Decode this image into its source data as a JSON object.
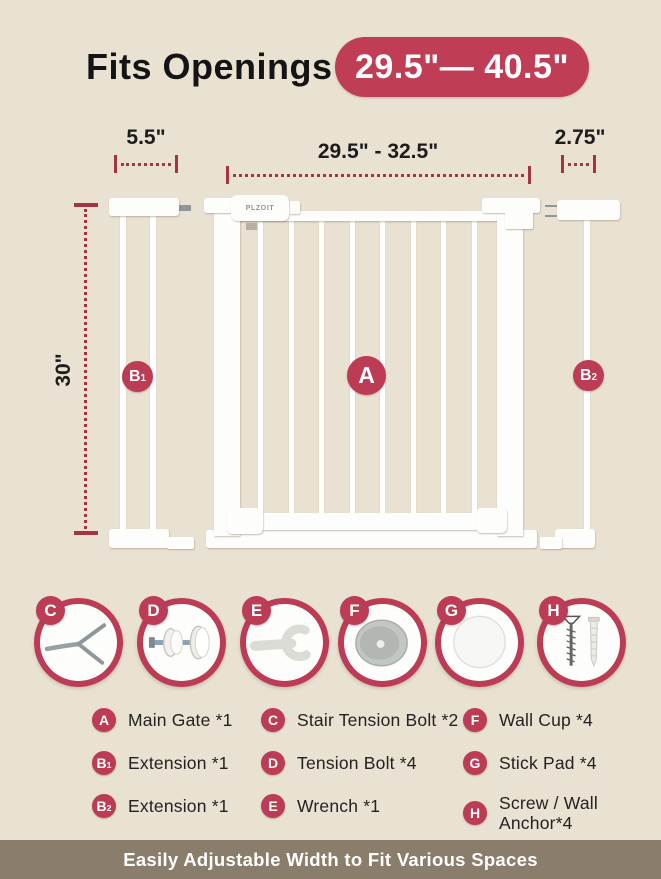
{
  "colors": {
    "background": "#e9e1d2",
    "accent_crimson": "#bc3c55",
    "dimension_line": "#a33447",
    "footer_bar": "#8b7d6b"
  },
  "header": {
    "title": "Fits Openings",
    "range_badge": "29.5\"— 40.5\""
  },
  "dimensions": {
    "extension_left_width": "5.5\"",
    "gate_width": "29.5\" - 32.5\"",
    "extension_right_width": "2.75\"",
    "gate_height": "30\""
  },
  "gate": {
    "brand": "PLZOIT",
    "badges": {
      "main": "A",
      "left_ext": {
        "letter": "B",
        "sub": "1"
      },
      "right_ext": {
        "letter": "B",
        "sub": "2"
      }
    }
  },
  "parts": [
    {
      "letter": "C",
      "icon": "stair-tension-bolt-icon"
    },
    {
      "letter": "D",
      "icon": "tension-bolt-icon"
    },
    {
      "letter": "E",
      "icon": "wrench-icon"
    },
    {
      "letter": "F",
      "icon": "wall-cup-icon"
    },
    {
      "letter": "G",
      "icon": "stick-pad-icon"
    },
    {
      "letter": "H",
      "icon": "screw-wall-anchor-icon"
    }
  ],
  "legend": {
    "col1": [
      {
        "badge": "A",
        "label": "Main Gate *1"
      },
      {
        "badge": "B",
        "sub": "1",
        "label": "Extension *1"
      },
      {
        "badge": "B",
        "sub": "2",
        "label": "Extension *1"
      }
    ],
    "col2": [
      {
        "badge": "C",
        "label": "Stair Tension Bolt *2"
      },
      {
        "badge": "D",
        "label": "Tension Bolt *4"
      },
      {
        "badge": "E",
        "label": "Wrench *1"
      }
    ],
    "col3": [
      {
        "badge": "F",
        "label": "Wall Cup *4"
      },
      {
        "badge": "G",
        "label": "Stick Pad *4"
      },
      {
        "badge": "H",
        "label": "Screw / Wall Anchor*4"
      }
    ]
  },
  "footer": {
    "text": "Easily Adjustable Width to Fit Various Spaces"
  }
}
